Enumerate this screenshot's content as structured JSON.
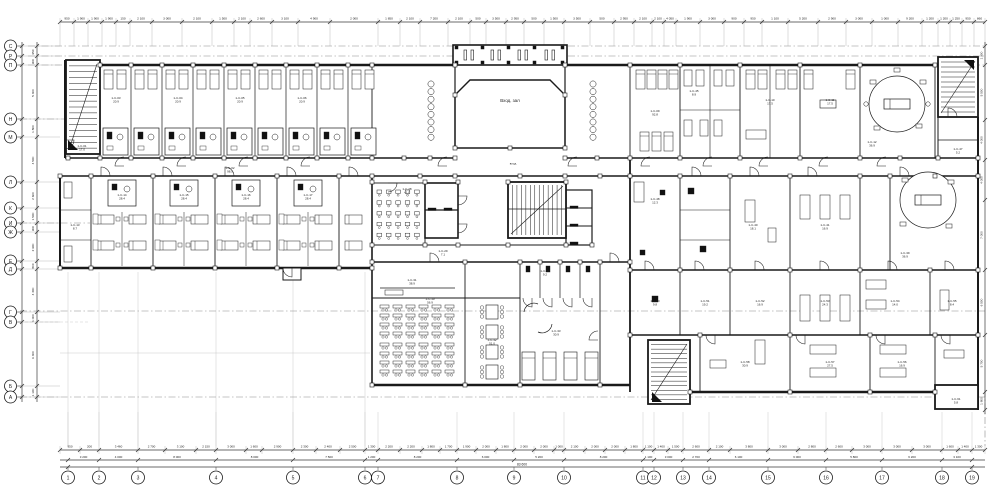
{
  "drawing": {
    "type": "architectural-floor-plan",
    "hall_label": "Вход. зал",
    "entrance_label": "вход",
    "total_length_label": "83 600"
  },
  "axes": {
    "left_letters": [
      "С",
      "Р",
      "П",
      "Н",
      "М",
      "Л",
      "К",
      "И",
      "Ж",
      "Е",
      "Д",
      "Г",
      "В",
      "Б",
      "А"
    ],
    "bottom_numbers": [
      "1",
      "2",
      "3",
      "4",
      "5",
      "6",
      "7",
      "8",
      "9",
      "10",
      "11",
      "12",
      "13",
      "14",
      "15",
      "16",
      "17",
      "18",
      "19"
    ]
  },
  "dimensions": {
    "top": [
      "950",
      "1 900",
      "1 900",
      "1 900",
      "150",
      "2 100",
      "3 000",
      "2 100",
      "1 500",
      "2 100",
      "2 600",
      "3 100",
      "4 900",
      "2 000",
      "1 850",
      "2 100",
      "7 200",
      "2 100",
      "500",
      "3 500",
      "2 950",
      "500",
      "1 500",
      "3 500",
      "500",
      "2 950",
      "2 100",
      "2 100",
      "4 050",
      "1 900",
      "3 000",
      "900",
      "950",
      "1 100",
      "5 200",
      "2 900",
      "3 000",
      "1 000",
      "9 200",
      "1 200",
      "1 200",
      "1 250",
      "950",
      "860"
    ],
    "bottom_segments": [
      "950",
      "200",
      "3 460",
      "2 700",
      "3 100",
      "2 150",
      "3 000",
      "1 600",
      "2 900",
      "2 300",
      "2 400",
      "2 500",
      "1 300",
      "2 200",
      "2 200",
      "1 800",
      "1 700",
      "1 900",
      "2 000",
      "1 800",
      "2 000",
      "2 000",
      "1 000",
      "2 100",
      "2 000",
      "2 000",
      "1 800",
      "1 100",
      "1 400",
      "1 500",
      "2 600",
      "2 100",
      "3 800",
      "3 000",
      "2 800",
      "2 600",
      "3 000",
      "3 000",
      "3 000",
      "1 600",
      "1 400",
      "1 300"
    ],
    "bottom_axes": [
      "3 200",
      "4 000",
      "8 000",
      "8 000",
      "7 500",
      "1 200",
      "8 200",
      "6 000",
      "5 200",
      "8 200",
      "1 100",
      "3 000",
      "2 700",
      "6 100",
      "6 000",
      "5 800",
      "6 200",
      "3 100"
    ],
    "left": [
      "950",
      "900",
      "5 400",
      "1 800",
      "4 500",
      "2 600",
      "1 500",
      "900",
      "2 900",
      "800",
      "4 300",
      "1 000",
      "6 400",
      "1 100"
    ],
    "right": [
      "1 900",
      "5 500",
      "4 000",
      "4 000",
      "7 000",
      "6 500",
      "5 700",
      "1 800"
    ]
  },
  "rooms": [
    {
      "code": "1-С-01",
      "area": "17.0"
    },
    {
      "code": "1-С-03",
      "area": "20.9"
    },
    {
      "code": "1-С-04",
      "area": "20.9"
    },
    {
      "code": "1-С-05",
      "area": "20.9"
    },
    {
      "code": "1-С-06",
      "area": "20.9"
    },
    {
      "code": "1-С-02",
      "area": "98.5"
    },
    {
      "code": "1-С-13",
      "area": "8.7"
    },
    {
      "code": "1-С-14",
      "area": "28.4"
    },
    {
      "code": "1-С-15",
      "area": "28.4"
    },
    {
      "code": "1-С-16",
      "area": "28.4"
    },
    {
      "code": "1-С-17",
      "area": "28.4"
    },
    {
      "code": "1-С-28",
      "area": "41.0"
    },
    {
      "code": "1-С-29",
      "area": "7.1"
    },
    {
      "code": "1-С-31",
      "area": "38.9"
    },
    {
      "code": "1-С-30",
      "area": "56.9"
    },
    {
      "code": "1-С-32",
      "area": "51.0"
    },
    {
      "code": "1-С-33",
      "area": "30.9"
    },
    {
      "code": "1-С-34",
      "area": "9.2"
    },
    {
      "code": "1-С-09",
      "area": "92.8"
    },
    {
      "code": "1-С-45",
      "area": "8.9"
    },
    {
      "code": "1-С-10",
      "area": "17.5"
    },
    {
      "code": "1-С-11",
      "area": "17.5"
    },
    {
      "code": "1-С-12",
      "area": "36.9"
    },
    {
      "code": "1-С-47",
      "area": "5.2"
    },
    {
      "code": "1-С-48",
      "area": "12.3"
    },
    {
      "code": "1-С-40",
      "area": "18.1"
    },
    {
      "code": "1-С-41",
      "area": "16.9"
    },
    {
      "code": "1-С-39",
      "area": "36.9"
    },
    {
      "code": "1-С-50",
      "area": "9.8"
    },
    {
      "code": "1-С-51",
      "area": "19.2"
    },
    {
      "code": "1-С-52",
      "area": "16.9"
    },
    {
      "code": "1-С-53",
      "area": "24.3"
    },
    {
      "code": "1-С-54",
      "area": "14.0"
    },
    {
      "code": "1-С-55",
      "area": "8.4"
    },
    {
      "code": "1-С-58",
      "area": "30.9"
    },
    {
      "code": "1-С-57",
      "area": "27.5"
    },
    {
      "code": "1-С-56",
      "area": "16.9"
    },
    {
      "code": "1-С-61",
      "area": "5.8"
    }
  ],
  "colors": {
    "line": "#1a1a1a",
    "partition": "#2a2a2a",
    "dim": "#3a3a3a",
    "chain": "#8a8a8a",
    "faint": "#c9c9c9",
    "paper": "#ffffff",
    "fill_dark": "#111111"
  }
}
